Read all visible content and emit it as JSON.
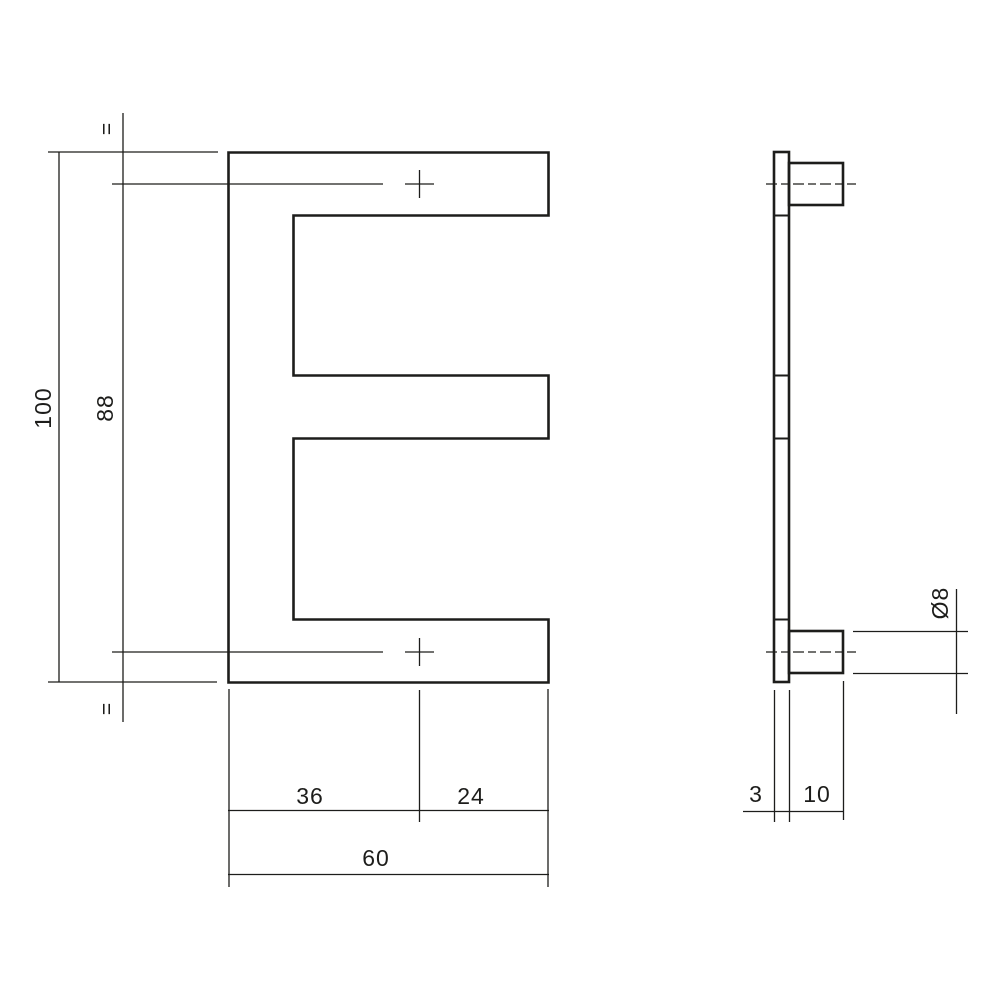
{
  "drawing": {
    "type": "technical-drawing",
    "subject": "house letter E with mounting pins",
    "units": "mm",
    "colors": {
      "line": "#1d1d1b",
      "background": "#ffffff"
    },
    "front_view": {
      "dim_total_height": "100",
      "dim_hole_spacing": "88",
      "dim_hole_offset_left": "36",
      "dim_hole_offset_right": "24",
      "dim_total_width": "60",
      "equal_mark_top": "=",
      "equal_mark_bottom": "="
    },
    "side_view": {
      "dim_plate_thickness": "3",
      "dim_pin_length": "10",
      "dim_pin_diameter": "Ø8"
    }
  }
}
